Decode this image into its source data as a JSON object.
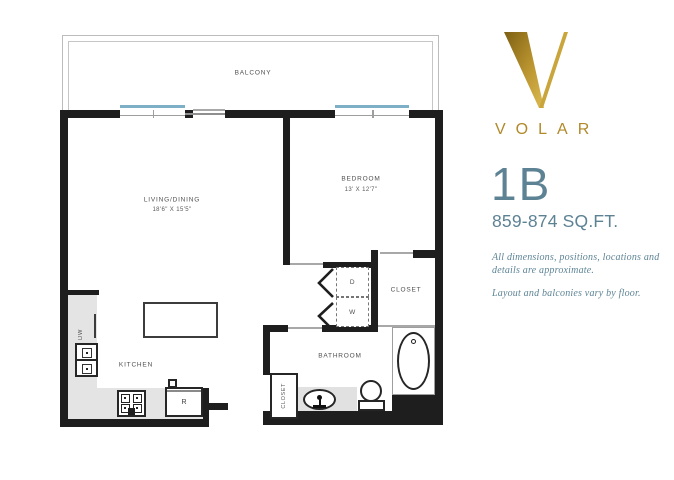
{
  "branding": {
    "wordmark": "VOLAR",
    "unit_name": "1B",
    "unit_area": "859-874 SQ.FT.",
    "disclaimer_line1": "All dimensions, positions, locations and",
    "disclaimer_line2": "details are approximate.",
    "disclaimer_line3": "Layout and balconies vary by floor.",
    "gold_color": "#b1892a",
    "blue_color": "#5d8294"
  },
  "rooms": {
    "balcony": "BALCONY",
    "living_dining_label": "LIVING/DINING",
    "living_dining_dims": "18'6\" X 15'5\"",
    "bedroom_label": "BEDROOM",
    "bedroom_dims": "13' X 12'7\"",
    "kitchen": "KITCHEN",
    "bathroom": "BATHROOM",
    "bedroom_closet": "CLOSET",
    "entry_closet": "CLOSET"
  },
  "fixtures": {
    "dryer": "D",
    "washer": "W",
    "dishwasher": "DW",
    "refrigerator": "R"
  },
  "plan_colors": {
    "wall": "#1e1e1e",
    "window": "#7dafc6",
    "counter": "#e4e4e4"
  }
}
